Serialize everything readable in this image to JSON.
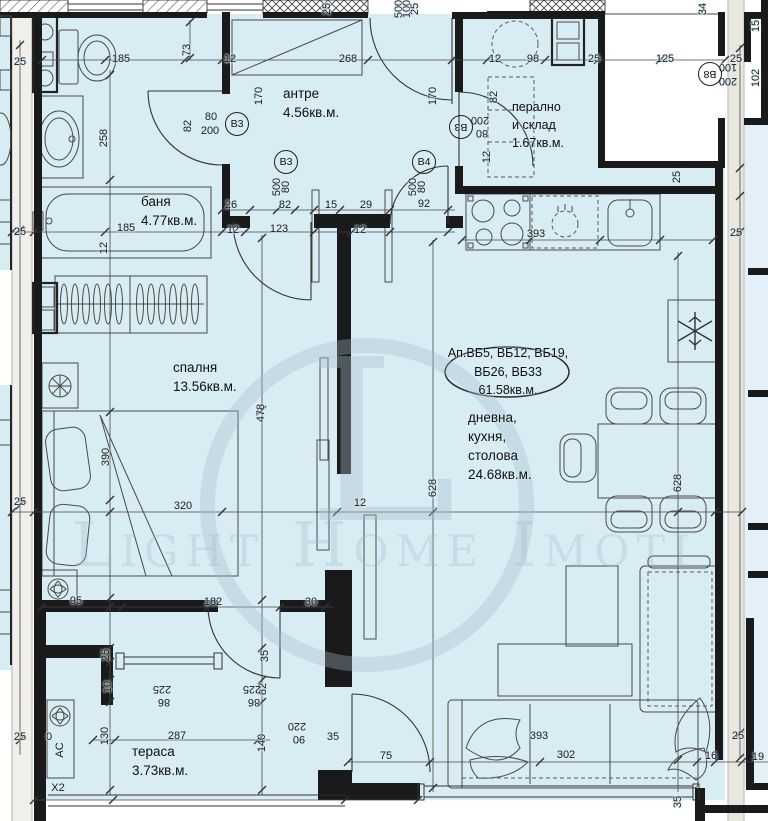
{
  "title": "apartment floor plan",
  "watermark": {
    "logo_letter": "L",
    "text": "Light Home Imoti"
  },
  "apartment": {
    "line1": "Ап.ВБ5, ВБ12, ВБ19,",
    "line2": "ВБ26, ВБ33",
    "line3": "61.58кв.м."
  },
  "rooms": {
    "bathroom": {
      "name": "баня",
      "area": "4.77кв.м."
    },
    "hallway": {
      "name": "антре",
      "area": "4.56кв.м."
    },
    "laundry": {
      "name": "перално",
      "name2": "и склад",
      "area": "1.67кв.м."
    },
    "bedroom": {
      "name": "спалня",
      "area": "13.56кв.м."
    },
    "living": {
      "name": "дневна,",
      "name2": "кухня,",
      "name3": "столова",
      "area": "24.68кв.м."
    },
    "terrace": {
      "name": "тераса",
      "area": "3.73кв.м."
    }
  },
  "door_tags": [
    {
      "label": "В3",
      "x": 237,
      "y": 124
    },
    {
      "label": "В3",
      "x": 286,
      "y": 162
    },
    {
      "label": "В4",
      "x": 424,
      "y": 162
    },
    {
      "label": "В3",
      "x": 461,
      "y": 127,
      "flip": true
    },
    {
      "label": "В8",
      "x": 710,
      "y": 74,
      "flip": true
    }
  ],
  "dim_labels": [
    {
      "t": "25",
      "x": 20,
      "y": 62
    },
    {
      "t": "185",
      "x": 121,
      "y": 59
    },
    {
      "t": "73",
      "x": 187,
      "y": 50,
      "r": 90
    },
    {
      "t": "12",
      "x": 230,
      "y": 59
    },
    {
      "t": "268",
      "x": 348,
      "y": 59
    },
    {
      "t": "25",
      "x": 327,
      "y": 9,
      "r": 90
    },
    {
      "t": "500",
      "x": 399,
      "y": 9,
      "r": 90
    },
    {
      "t": "100",
      "x": 407,
      "y": 9,
      "r": 90
    },
    {
      "t": "25",
      "x": 415,
      "y": 9,
      "r": 90
    },
    {
      "t": "12",
      "x": 495,
      "y": 59
    },
    {
      "t": "98",
      "x": 533,
      "y": 59
    },
    {
      "t": "25",
      "x": 594,
      "y": 59
    },
    {
      "t": "125",
      "x": 665,
      "y": 59
    },
    {
      "t": "25",
      "x": 736,
      "y": 59
    },
    {
      "t": "34",
      "x": 703,
      "y": 9,
      "r": 90
    },
    {
      "t": "15",
      "x": 756,
      "y": 26,
      "r": 90
    },
    {
      "t": "102",
      "x": 756,
      "y": 78,
      "r": 90
    },
    {
      "t": "100",
      "x": 728,
      "y": 67,
      "r": 180
    },
    {
      "t": "200",
      "x": 728,
      "y": 81,
      "r": 180
    },
    {
      "t": "258",
      "x": 104,
      "y": 138,
      "r": 90
    },
    {
      "t": "82",
      "x": 188,
      "y": 126,
      "r": 90
    },
    {
      "t": "80",
      "x": 211,
      "y": 117
    },
    {
      "t": "200",
      "x": 210,
      "y": 131
    },
    {
      "t": "185",
      "x": 126,
      "y": 228
    },
    {
      "t": "12",
      "x": 104,
      "y": 248,
      "r": 90
    },
    {
      "t": "25",
      "x": 20,
      "y": 232
    },
    {
      "t": "26",
      "x": 231,
      "y": 205
    },
    {
      "t": "12",
      "x": 233,
      "y": 230
    },
    {
      "t": "170",
      "x": 259,
      "y": 96,
      "r": 90
    },
    {
      "t": "170",
      "x": 433,
      "y": 96,
      "r": 90
    },
    {
      "t": "500",
      "x": 277,
      "y": 187,
      "r": 90
    },
    {
      "t": "80",
      "x": 286,
      "y": 187,
      "r": 90
    },
    {
      "t": "500",
      "x": 413,
      "y": 187,
      "r": 90
    },
    {
      "t": "80",
      "x": 422,
      "y": 187,
      "r": 90
    },
    {
      "t": "82",
      "x": 285,
      "y": 205
    },
    {
      "t": "15",
      "x": 331,
      "y": 205
    },
    {
      "t": "29",
      "x": 366,
      "y": 205
    },
    {
      "t": "92",
      "x": 424,
      "y": 204
    },
    {
      "t": "123",
      "x": 279,
      "y": 229
    },
    {
      "t": "12",
      "x": 360,
      "y": 230
    },
    {
      "t": "82",
      "x": 494,
      "y": 97,
      "r": 90
    },
    {
      "t": "200",
      "x": 480,
      "y": 120,
      "r": 180
    },
    {
      "t": "80",
      "x": 482,
      "y": 133,
      "r": 180
    },
    {
      "t": "12",
      "x": 487,
      "y": 157,
      "r": 90
    },
    {
      "t": "393",
      "x": 536,
      "y": 234
    },
    {
      "t": "25",
      "x": 677,
      "y": 177,
      "r": 90
    },
    {
      "t": "25",
      "x": 736,
      "y": 233
    },
    {
      "t": "478",
      "x": 261,
      "y": 413,
      "r": 90
    },
    {
      "t": "390",
      "x": 106,
      "y": 457,
      "r": 90
    },
    {
      "t": "320",
      "x": 183,
      "y": 506
    },
    {
      "t": "12",
      "x": 360,
      "y": 503
    },
    {
      "t": "25",
      "x": 20,
      "y": 502
    },
    {
      "t": "628",
      "x": 433,
      "y": 488,
      "r": 90
    },
    {
      "t": "628",
      "x": 678,
      "y": 483,
      "r": 90
    },
    {
      "t": "95",
      "x": 76,
      "y": 601
    },
    {
      "t": "182",
      "x": 213,
      "y": 602
    },
    {
      "t": "30",
      "x": 311,
      "y": 602
    },
    {
      "t": "25",
      "x": 106,
      "y": 655,
      "r": 90
    },
    {
      "t": "10",
      "x": 108,
      "y": 687,
      "r": 90
    },
    {
      "t": "35",
      "x": 265,
      "y": 656,
      "r": 90
    },
    {
      "t": "82",
      "x": 263,
      "y": 689,
      "r": 90
    },
    {
      "t": "225",
      "x": 162,
      "y": 689,
      "r": 180
    },
    {
      "t": "86",
      "x": 164,
      "y": 702,
      "r": 180
    },
    {
      "t": "225",
      "x": 252,
      "y": 689,
      "r": 180
    },
    {
      "t": "86",
      "x": 254,
      "y": 702,
      "r": 180
    },
    {
      "t": "220",
      "x": 297,
      "y": 726,
      "r": 180
    },
    {
      "t": "90",
      "x": 299,
      "y": 739,
      "r": 180
    },
    {
      "t": "25",
      "x": 20,
      "y": 737
    },
    {
      "t": "0",
      "x": 49,
      "y": 737
    },
    {
      "t": "130",
      "x": 105,
      "y": 736,
      "r": 90
    },
    {
      "t": "287",
      "x": 177,
      "y": 736
    },
    {
      "t": "140",
      "x": 262,
      "y": 743,
      "r": 90
    },
    {
      "t": "AC",
      "x": 60,
      "y": 750,
      "r": 90
    },
    {
      "t": "X2",
      "x": 58,
      "y": 788
    },
    {
      "t": "35",
      "x": 333,
      "y": 737
    },
    {
      "t": "75",
      "x": 386,
      "y": 756
    },
    {
      "t": "393",
      "x": 539,
      "y": 736
    },
    {
      "t": "302",
      "x": 566,
      "y": 755
    },
    {
      "t": "25",
      "x": 738,
      "y": 736
    },
    {
      "t": "16",
      "x": 711,
      "y": 756
    },
    {
      "t": "19",
      "x": 758,
      "y": 757
    },
    {
      "t": "35",
      "x": 678,
      "y": 802,
      "r": 90
    }
  ],
  "colors": {
    "room_fill": "#d8ecf4",
    "wall": "#1a1a1a",
    "gap_strip": "#f1efe9",
    "right_strip": "#eae7e1",
    "watermark": "#a5bccb",
    "dim_text": "#1d1d1d"
  }
}
